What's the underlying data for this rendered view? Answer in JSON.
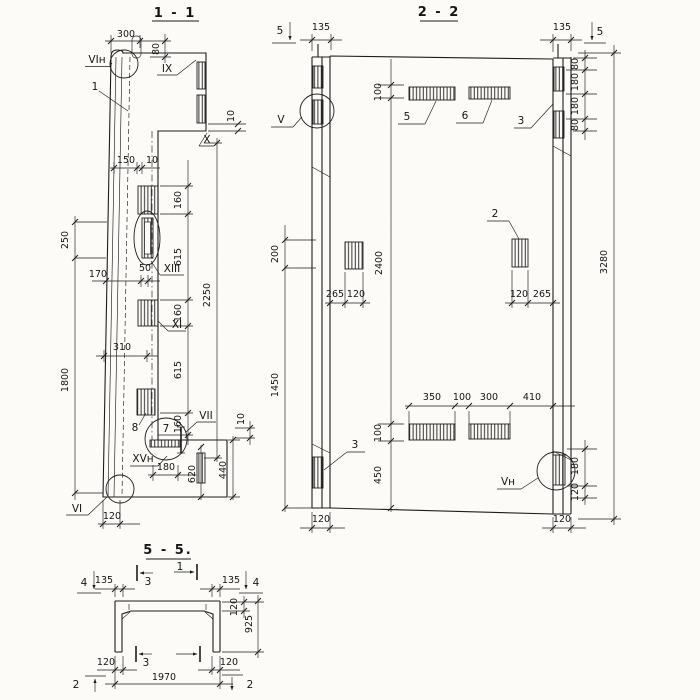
{
  "colors": {
    "paper": "#fcfbf8",
    "ink": "#1d1d1d"
  },
  "section11": {
    "title": "1 - 1",
    "dims": {
      "w300": "300",
      "h80": "80",
      "t10": "10",
      "w150": "150",
      "w10": "10",
      "h250": "250",
      "w170": "170",
      "w50": "50",
      "h1800": "1800",
      "c160a": "160",
      "c615a": "615",
      "c160b": "160",
      "c615b": "615",
      "c160c": "160",
      "h2250": "2250",
      "w310": "310",
      "b10": "10",
      "w180": "180",
      "h620": "620",
      "h440": "440",
      "w120": "120"
    },
    "labels": {
      "part1": "1",
      "part7": "7",
      "part8": "8",
      "ix": "IX",
      "x": "X",
      "xi": "XI",
      "xiii": "XIII",
      "vii": "VII",
      "vi": "VI",
      "vi_n": "VIн",
      "xv_n": "XVн"
    }
  },
  "section22": {
    "title": "2 - 2",
    "dims": {
      "w135l": "135",
      "w135r": "135",
      "c80a": "80",
      "c180a": "180",
      "c180b": "180",
      "c80b": "80",
      "h3280": "3280",
      "h100t": "100",
      "h2400": "2400",
      "h100b": "100",
      "h450": "450",
      "h200": "200",
      "h1450": "1450",
      "w265l": "265",
      "w120l": "120",
      "w120r": "120",
      "w265r": "265",
      "w350": "350",
      "w100": "100",
      "w300": "300",
      "w410": "410",
      "c180c": "180",
      "c120c": "120",
      "w120bl": "120",
      "w120br": "120"
    },
    "labels": {
      "cut5l": "5",
      "cut5r": "5",
      "part5": "5",
      "part6": "6",
      "part3a": "3",
      "part3b": "3",
      "part2": "2",
      "v": "V",
      "v_n": "Vн"
    }
  },
  "section55": {
    "title": "5 - 5.",
    "dims": {
      "w135l": "135",
      "w135r": "135",
      "t120": "120",
      "h925": "925",
      "w120l": "120",
      "w120r": "120",
      "w1970": "1970"
    },
    "labels": {
      "cut4l": "4",
      "cut4r": "4",
      "cut3t": "3",
      "cut1t": "1",
      "cut3b": "3",
      "cut2l": "2",
      "cut2r": "2"
    }
  }
}
